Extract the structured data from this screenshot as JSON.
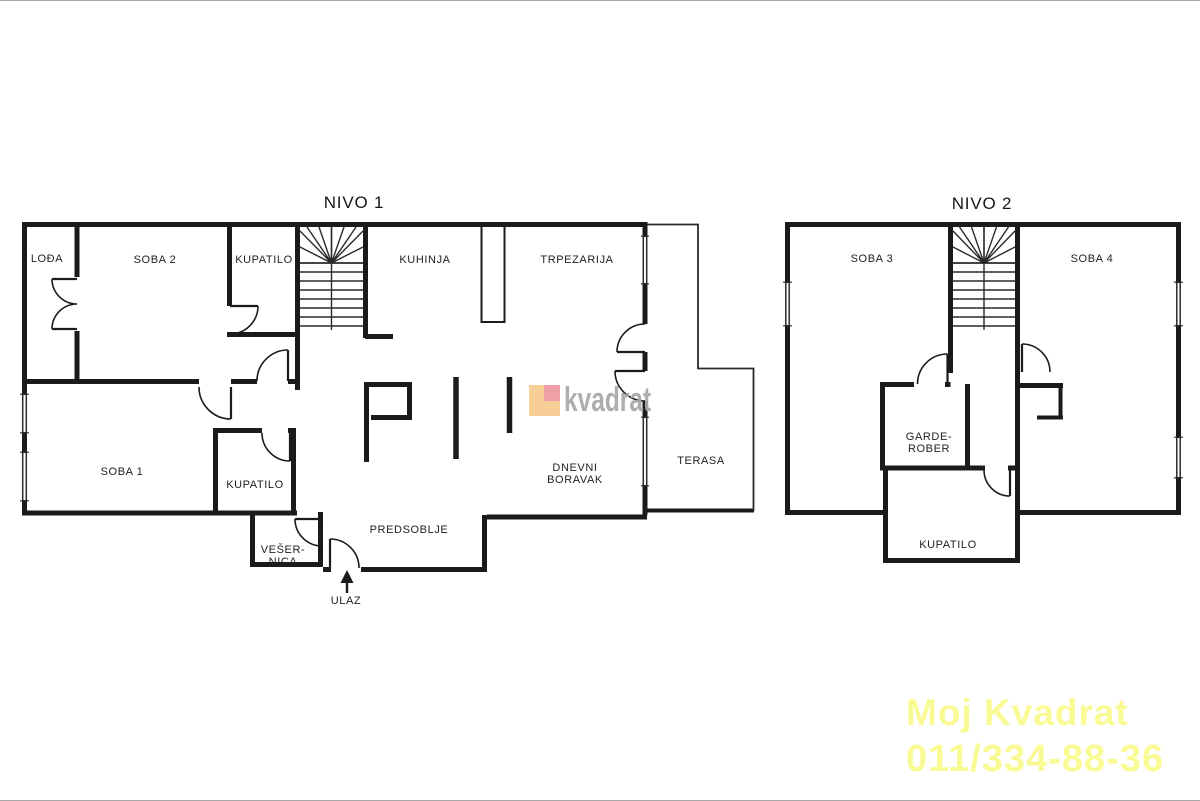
{
  "nivo1": {
    "title": "NIVO 1",
    "rooms": {
      "lodja": "LOĐA",
      "soba2": "SOBA 2",
      "kupatilo_gornji": "KUPATILO",
      "kuhinja": "KUHINJA",
      "trpezarija": "TRPEZARIJA",
      "soba1": "SOBA 1",
      "kupatilo_srednji": "KUPATILO",
      "dnevni_boravak_line1": "DNEVNI",
      "dnevni_boravak_line2": "BORAVAK",
      "terasa": "TERASA",
      "vesernica_line1": "VEŠER-",
      "vesernica_line2": "NICA",
      "predsoblje": "PREDSOBLJE",
      "ulaz": "ULAZ"
    }
  },
  "nivo2": {
    "title": "NIVO 2",
    "rooms": {
      "soba3": "SOBA 3",
      "soba4": "SOBA 4",
      "garderober_line1": "GARDE-",
      "garderober_line2": "ROBER",
      "kupatilo": "KUPATILO"
    }
  },
  "watermark": {
    "text": "kvadrat",
    "text_color": "#a8a8a8",
    "logo_color": "#f6ce96",
    "logo_accent_color": "#efa0a6"
  },
  "footer": {
    "line1": "Moj Kvadrat",
    "line2": "011/334-88-36",
    "color": "#fafa94"
  },
  "colors": {
    "walls": "#1b1b1b",
    "background": "#ffffff",
    "label_text": "#1f1f1f"
  }
}
